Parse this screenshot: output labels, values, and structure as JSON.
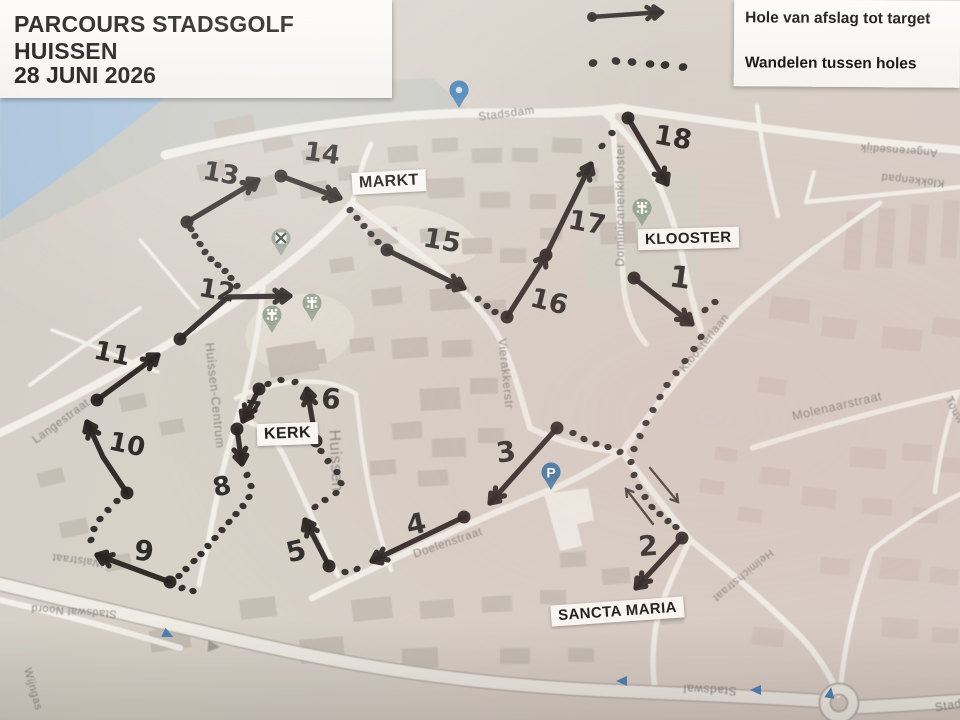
{
  "title_card": {
    "line1": "PARCOURS STADSGOLF HUISSEN",
    "line2": "28 JUNI 2026"
  },
  "legend": {
    "items": [
      {
        "icon": "solid-arrow-icon",
        "label": "Hole van afslag tot target"
      },
      {
        "icon": "dotted-line-icon",
        "label": "Wandelen tussen holes"
      }
    ],
    "sample_arrow": {
      "from": [
        592,
        17
      ],
      "to": [
        662,
        12
      ]
    },
    "sample_dots": [
      [
        593,
        63
      ],
      [
        616,
        61
      ],
      [
        632,
        62
      ],
      [
        650,
        64
      ],
      [
        665,
        65
      ],
      [
        683,
        67
      ]
    ]
  },
  "place_labels": [
    {
      "text": "MARKT",
      "x": 352,
      "y": 171,
      "rot": -3,
      "size": 16
    },
    {
      "text": "KLOOSTER",
      "x": 638,
      "y": 228,
      "rot": -1.5,
      "size": 15
    },
    {
      "text": "KERK",
      "x": 257,
      "y": 423,
      "rot": -2,
      "size": 16
    },
    {
      "text": "SANCTA MARIA",
      "x": 551,
      "y": 601,
      "rot": -4,
      "size": 15
    }
  ],
  "street_labels": [
    {
      "text": "Stadsdam",
      "x": 507,
      "y": 117,
      "rot": -7,
      "size": 11.5
    },
    {
      "text": "Dominicanenklooster",
      "x": 624,
      "y": 205,
      "rot": -90,
      "size": 12
    },
    {
      "text": "Kloosterlaan",
      "x": 707,
      "y": 345,
      "rot": -51,
      "size": 11.5
    },
    {
      "text": "Klokkenpad",
      "x": 913,
      "y": 177,
      "rot": 186,
      "size": 11
    },
    {
      "text": "Angerensedijk",
      "x": 899,
      "y": 147,
      "rot": 184,
      "size": 11
    },
    {
      "text": "Molenaarstraat",
      "x": 838,
      "y": 410,
      "rot": -13,
      "size": 12.5
    },
    {
      "text": "Touw",
      "x": 952,
      "y": 412,
      "rot": 62,
      "size": 11.5
    },
    {
      "text": "Helmichstraat",
      "x": 741,
      "y": 573,
      "rot": 140,
      "size": 11
    },
    {
      "text": "Stadswal",
      "x": 710,
      "y": 686,
      "rot": 183,
      "size": 12
    },
    {
      "text": "Stadswal",
      "x": 962,
      "y": 707,
      "rot": -10,
      "size": 12
    },
    {
      "text": "Stadswal Noord",
      "x": 74,
      "y": 608,
      "rot": 184,
      "size": 11
    },
    {
      "text": "Doelenstraat",
      "x": 449,
      "y": 546,
      "rot": -19,
      "size": 11.5
    },
    {
      "text": "Langestraat",
      "x": 63,
      "y": 424,
      "rot": -36,
      "size": 11.5
    },
    {
      "text": "Walstraat",
      "x": 78,
      "y": 557,
      "rot": 187,
      "size": 11
    },
    {
      "text": "Wijngas",
      "x": 30,
      "y": 690,
      "rot": 74,
      "size": 11
    },
    {
      "text": "Huissen-Centrum",
      "x": 211,
      "y": 396,
      "rot": 84,
      "size": 12.5
    },
    {
      "text": "Huissen",
      "x": 331,
      "y": 461,
      "rot": 87,
      "size": 16
    },
    {
      "text": "Vierakkerstr",
      "x": 502,
      "y": 374,
      "rot": 84,
      "size": 12
    }
  ],
  "course": {
    "ink_color": "#2a2522",
    "holes": [
      {
        "n": "1",
        "pts": [
          [
            634,
            278
          ],
          [
            692,
            324
          ]
        ],
        "label": {
          "x": 680,
          "y": 278,
          "rot": 8,
          "size": 30
        }
      },
      {
        "n": "2",
        "pts": [
          [
            682,
            538
          ],
          [
            636,
            588
          ]
        ],
        "label": {
          "x": 648,
          "y": 546,
          "rot": -4,
          "size": 28
        }
      },
      {
        "n": "3",
        "pts": [
          [
            557,
            428
          ],
          [
            490,
            503
          ]
        ],
        "label": {
          "x": 506,
          "y": 452,
          "rot": -8,
          "size": 28
        }
      },
      {
        "n": "4",
        "pts": [
          [
            464,
            517
          ],
          [
            372,
            561
          ]
        ],
        "label": {
          "x": 416,
          "y": 524,
          "rot": -12,
          "size": 28
        }
      },
      {
        "n": "5",
        "pts": [
          [
            329,
            566
          ],
          [
            305,
            520
          ]
        ],
        "label": {
          "x": 296,
          "y": 551,
          "rot": -14,
          "size": 28
        }
      },
      {
        "n": "6",
        "pts": [
          [
            316,
            441
          ],
          [
            307,
            389
          ]
        ],
        "label": {
          "x": 331,
          "y": 399,
          "rot": 4,
          "size": 28
        }
      },
      {
        "n": "7",
        "pts": [
          [
            259,
            389
          ],
          [
            243,
            421
          ]
        ],
        "label": {
          "x": 253,
          "y": 410,
          "rot": 8,
          "size": 24
        }
      },
      {
        "n": "8",
        "pts": [
          [
            237,
            429
          ],
          [
            242,
            464
          ]
        ],
        "label": {
          "x": 222,
          "y": 487,
          "rot": -12,
          "size": 26
        }
      },
      {
        "n": "9",
        "pts": [
          [
            170,
            582
          ],
          [
            97,
            555
          ]
        ],
        "label": {
          "x": 144,
          "y": 551,
          "rot": 6,
          "size": 28
        }
      },
      {
        "n": "10",
        "pts": [
          [
            127,
            493
          ],
          [
            103,
            457
          ],
          [
            87,
            422
          ]
        ],
        "label": {
          "x": 127,
          "y": 445,
          "rot": 12,
          "size": 26
        }
      },
      {
        "n": "11",
        "pts": [
          [
            97,
            400
          ],
          [
            158,
            355
          ]
        ],
        "label": {
          "x": 112,
          "y": 354,
          "rot": 12,
          "size": 26
        }
      },
      {
        "n": "12",
        "pts": [
          [
            180,
            339
          ],
          [
            228,
            297
          ],
          [
            290,
            296
          ]
        ],
        "label": {
          "x": 217,
          "y": 291,
          "rot": 10,
          "size": 26
        }
      },
      {
        "n": "13",
        "pts": [
          [
            187,
            222
          ],
          [
            258,
            180
          ]
        ],
        "label": {
          "x": 221,
          "y": 174,
          "rot": 10,
          "size": 26
        }
      },
      {
        "n": "14",
        "pts": [
          [
            281,
            176
          ],
          [
            340,
            198
          ]
        ],
        "label": {
          "x": 322,
          "y": 154,
          "rot": 8,
          "size": 26
        }
      },
      {
        "n": "15",
        "pts": [
          [
            387,
            250
          ],
          [
            464,
            288
          ]
        ],
        "label": {
          "x": 442,
          "y": 241,
          "rot": 10,
          "size": 27
        }
      },
      {
        "n": "16",
        "pts": [
          [
            507,
            317
          ],
          [
            545,
            257
          ]
        ],
        "label": {
          "x": 549,
          "y": 302,
          "rot": 14,
          "size": 27
        },
        "head": 1,
        "enddot": true
      },
      {
        "n": "17",
        "pts": [
          [
            546,
            255
          ],
          [
            591,
            164
          ]
        ],
        "label": {
          "x": 587,
          "y": 223,
          "rot": 10,
          "size": 27
        }
      },
      {
        "n": "18",
        "pts": [
          [
            628,
            118
          ],
          [
            667,
            184
          ]
        ],
        "label": {
          "x": 673,
          "y": 138,
          "rot": 10,
          "size": 27
        }
      }
    ],
    "walks": [
      [
        [
          705,
          310
        ],
        [
          715,
          302
        ]
      ],
      [
        [
          701,
          337
        ],
        [
          694,
          349
        ],
        [
          685,
          361
        ],
        [
          676,
          373
        ],
        [
          667,
          385
        ],
        [
          660,
          397
        ],
        [
          653,
          410
        ],
        [
          646,
          423
        ],
        [
          640,
          436
        ],
        [
          634,
          449
        ],
        [
          631,
          462
        ]
      ],
      [
        [
          634,
          475
        ],
        [
          639,
          487
        ],
        [
          645,
          497
        ],
        [
          652,
          507
        ],
        [
          660,
          514
        ],
        [
          668,
          521
        ],
        [
          676,
          527
        ]
      ],
      [
        [
          620,
          452
        ],
        [
          608,
          447
        ],
        [
          596,
          444
        ],
        [
          584,
          439
        ],
        [
          573,
          433
        ]
      ],
      [
        [
          357,
          569
        ],
        [
          345,
          572
        ]
      ],
      [
        [
          315,
          507
        ],
        [
          325,
          500
        ],
        [
          336,
          493
        ],
        [
          341,
          483
        ],
        [
          337,
          472
        ],
        [
          328,
          461
        ],
        [
          321,
          451
        ]
      ],
      [
        [
          295,
          382
        ],
        [
          281,
          380
        ],
        [
          268,
          384
        ]
      ],
      [
        [
          247,
          475
        ],
        [
          251,
          486
        ],
        [
          249,
          497
        ],
        [
          243,
          506
        ],
        [
          236,
          514
        ],
        [
          229,
          522
        ],
        [
          222,
          530
        ],
        [
          215,
          538
        ],
        [
          208,
          546
        ],
        [
          201,
          554
        ],
        [
          194,
          561
        ],
        [
          186,
          569
        ],
        [
          179,
          576
        ]
      ],
      [
        [
          182,
          588
        ],
        [
          193,
          591
        ]
      ],
      [
        [
          91,
          540
        ],
        [
          94,
          529
        ],
        [
          100,
          519
        ],
        [
          108,
          510
        ],
        [
          117,
          501
        ]
      ],
      [
        [
          237,
          286
        ],
        [
          231,
          278
        ],
        [
          225,
          271
        ],
        [
          218,
          265
        ],
        [
          211,
          259
        ],
        [
          205,
          252
        ],
        [
          200,
          244
        ],
        [
          195,
          236
        ],
        [
          191,
          229
        ]
      ],
      [
        [
          350,
          210
        ],
        [
          357,
          218
        ],
        [
          364,
          226
        ],
        [
          371,
          234
        ],
        [
          378,
          242
        ]
      ],
      [
        [
          478,
          299
        ],
        [
          487,
          306
        ],
        [
          495,
          312
        ]
      ],
      [
        [
          602,
          146
        ],
        [
          612,
          133
        ]
      ]
    ],
    "pen_arrows": [
      {
        "from": [
          653,
          524
        ],
        "to": [
          626,
          489
        ]
      },
      {
        "from": [
          650,
          468
        ],
        "to": [
          678,
          502
        ]
      }
    ]
  },
  "poi_icons": [
    {
      "name": "windmill-poi-icon",
      "type": "mill",
      "x": 281,
      "y": 239
    },
    {
      "name": "church-poi-icon",
      "type": "church",
      "x": 272,
      "y": 316
    },
    {
      "name": "church-poi-icon",
      "type": "church",
      "x": 312,
      "y": 304
    },
    {
      "name": "klooster-poi-icon",
      "type": "church",
      "x": 642,
      "y": 209
    },
    {
      "name": "parking-icon",
      "type": "parking",
      "x": 551,
      "y": 473,
      "letter": "P"
    },
    {
      "name": "bus-stop-icon",
      "type": "blue",
      "x": 459,
      "y": 91
    }
  ],
  "oneway_arrows": [
    {
      "x": 167,
      "y": 634,
      "rot": 25
    },
    {
      "x": 623,
      "y": 681,
      "rot": 180
    },
    {
      "x": 757,
      "y": 690,
      "rot": 180
    },
    {
      "x": 830,
      "y": 694,
      "rot": -80
    }
  ],
  "colors": {
    "water": "#aac3db",
    "road": "#f3f0ea",
    "building": "#c6beb5",
    "building_pink": "#d2c3bd",
    "street_text": "#8b8781",
    "poi_green": "#93a48e",
    "parking_blue": "#4179a8",
    "oneway_blue": "#4a7fb5"
  }
}
